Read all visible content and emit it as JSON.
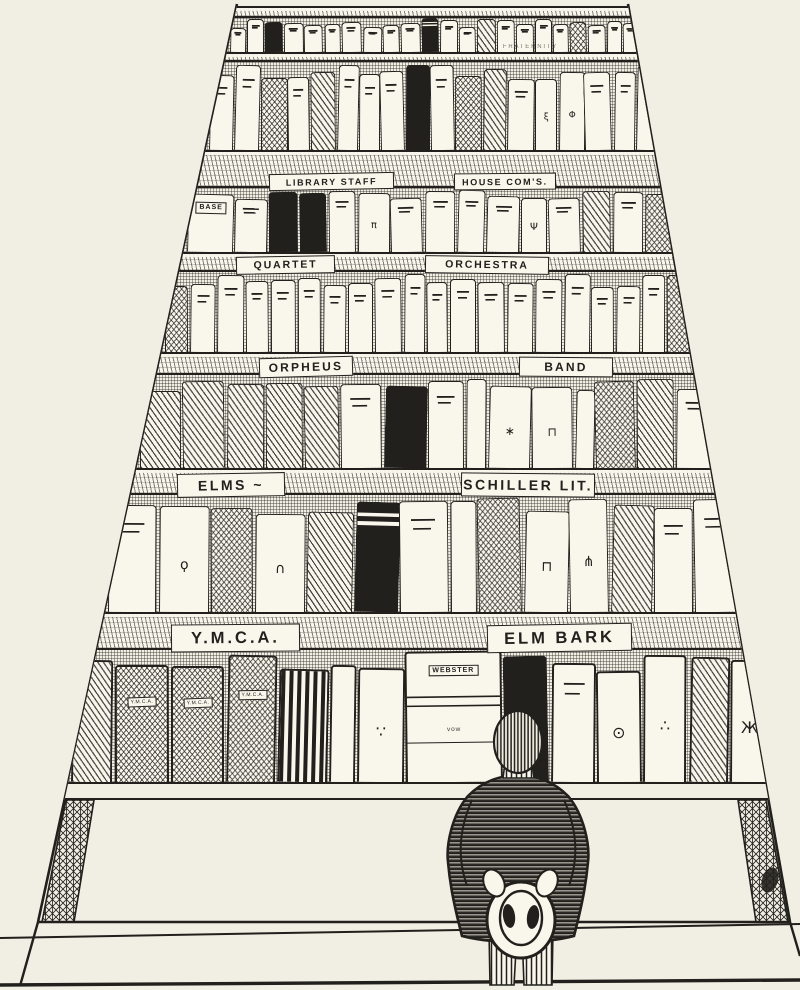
{
  "meta": {
    "width": 800,
    "height": 990
  },
  "colors": {
    "paper": "#f1eee3",
    "book_white": "#f9f6ec",
    "ink": "#21201c"
  },
  "bookcase": {
    "description": "tall seven-shelf bookcase drawn in steep upward perspective, pen-and-ink cartoon style, empty display shelf at the bottom"
  },
  "sections": [
    {
      "labels": [
        {
          "text": "FRATERNITY",
          "pos": 0.66,
          "w": 0.16,
          "tilt": 0,
          "bare": true
        }
      ]
    },
    {
      "labels": [
        {
          "text": "LIBRARY STAFF",
          "pos": 0.155,
          "w": 0.27,
          "tilt": -1
        },
        {
          "text": "HOUSE COM'S.",
          "pos": 0.555,
          "w": 0.22,
          "tilt": -0.5
        }
      ]
    },
    {
      "labels": [
        {
          "text": "QUARTET",
          "pos": 0.115,
          "w": 0.2,
          "tilt": -1
        },
        {
          "text": "ORCHESTRA",
          "pos": 0.495,
          "w": 0.25,
          "tilt": 0.8
        }
      ]
    },
    {
      "labels": [
        {
          "text": "ORPHEUS",
          "pos": 0.19,
          "w": 0.175,
          "tilt": -1.5
        },
        {
          "text": "BAND",
          "pos": 0.675,
          "w": 0.175,
          "tilt": 0.5
        }
      ]
    },
    {
      "labels": [
        {
          "text": "ELMS ~",
          "pos": 0.08,
          "w": 0.185,
          "tilt": -1
        },
        {
          "text": "SCHILLER LIT.",
          "pos": 0.565,
          "w": 0.23,
          "tilt": 0.5
        }
      ]
    },
    {
      "labels": [
        {
          "text": "Y.M.C.A.",
          "pos": 0.115,
          "w": 0.2,
          "tilt": -0.5
        },
        {
          "text": "ELM BARK",
          "pos": 0.605,
          "w": 0.225,
          "tilt": -1
        }
      ]
    }
  ],
  "spine_texts": {
    "base_book": "BASE",
    "dictionary_top": "WEBSTER",
    "dictionary_mid": "vow",
    "ymca_patch": "Y.M.C.A."
  },
  "shelves": [
    {
      "books": [
        "w",
        "w",
        "k",
        "w",
        "w",
        "w",
        "w",
        "w",
        "w",
        "w",
        "kb",
        "w",
        "w",
        "h",
        "w",
        "w",
        "w",
        "w",
        "c",
        "w",
        "w",
        "w"
      ]
    },
    {
      "books": [
        "w",
        "w",
        "c",
        "w",
        "h",
        "w",
        "w",
        "w",
        "k",
        "w",
        "c",
        "h",
        "w",
        "g:ξ",
        "g:Φ",
        "w",
        "w",
        "w"
      ]
    },
    {
      "books": [
        "L",
        "w",
        "k",
        "k",
        "w",
        "g:π",
        "w",
        "w",
        "w",
        "w",
        "g:Ψ",
        "w",
        "h",
        "w",
        "c"
      ]
    },
    {
      "books": [
        "c",
        "w",
        "w",
        "w",
        "w",
        "w",
        "w",
        "w",
        "w",
        "w",
        "w",
        "w",
        "w",
        "w",
        "w",
        "w",
        "w",
        "w",
        "w",
        "c"
      ]
    },
    {
      "books": [
        "h",
        "h",
        "h",
        "h",
        "h",
        "w",
        "k",
        "w",
        "t",
        "g:∗",
        "g:⊓",
        "t",
        "c",
        "h",
        "w"
      ]
    },
    {
      "books": [
        "w",
        "g:ϙ",
        "c",
        "g:∩",
        "h",
        "kb",
        "w",
        "t",
        "c",
        "g:⊓",
        "g:⋔",
        "h",
        "w",
        "w"
      ]
    },
    {
      "books": [
        "h",
        "P",
        "P",
        "P",
        "s",
        "t",
        "g:∵",
        "W",
        "k",
        "w",
        "g:⊙",
        "g:∴",
        "h",
        "g:Ж"
      ]
    }
  ],
  "figure": {
    "subject": "man seen from behind",
    "clothing": "dark horizontally-striped jacket, vertically-striped trousers",
    "holding": "straw hat held in both hands behind his back",
    "position": "standing at bottom center facing the bookshelf"
  }
}
